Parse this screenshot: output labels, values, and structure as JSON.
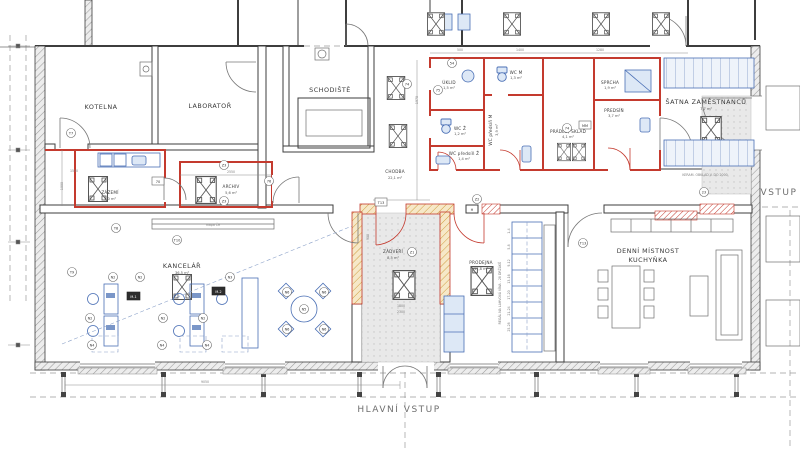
{
  "drawing": {
    "entrances": {
      "main": "HLAVNÍ VSTUP",
      "side": "VSTUP"
    },
    "rooms": [
      {
        "id": "kotelna",
        "name": "KOTELNA",
        "area": ""
      },
      {
        "id": "laborator",
        "name": "LABORATOŘ",
        "area": ""
      },
      {
        "id": "schodiste",
        "name": "SCHODIŠTĚ",
        "area": ""
      },
      {
        "id": "zazemi",
        "name": "ZÁZEMÍ",
        "area": "5,0 m²"
      },
      {
        "id": "archiv",
        "name": "ARCHIV",
        "area": "5,6 m²"
      },
      {
        "id": "chodba",
        "name": "CHODBA",
        "area": "22,1 m²"
      },
      {
        "id": "uklid",
        "name": "ÚKLID",
        "area": "1,5 m²"
      },
      {
        "id": "wc-z",
        "name": "WC Ž",
        "area": "1,2 m²"
      },
      {
        "id": "wc-predsin-z",
        "name": "WC předsíň Ž",
        "area": "1,4 m²"
      },
      {
        "id": "wc-m",
        "name": "WC M",
        "area": "1,3 m²"
      },
      {
        "id": "wc-predsin-m",
        "name": "WC předsíň M",
        "area": "3,9 m²"
      },
      {
        "id": "pradlo-sklad",
        "name": "PRÁDLO, SKLAD",
        "area": "4,1 m²"
      },
      {
        "id": "sprcha",
        "name": "SPRCHA",
        "area": "1,9 m²"
      },
      {
        "id": "predsin",
        "name": "PŘEDSÍŇ",
        "area": "3,7 m²"
      },
      {
        "id": "satna",
        "name": "ŠATNA ZAMĚSTNANCŮ",
        "area": "7,7 m²"
      },
      {
        "id": "kancelar",
        "name": "KANCELÁŘ",
        "area": "36,5 m²"
      },
      {
        "id": "zadveri",
        "name": "ZÁDVEŘÍ",
        "area": "8,5 m²"
      },
      {
        "id": "prodejna",
        "name": "PRODEJNA",
        "area": "11,8 m²"
      },
      {
        "id": "denni-mistnost",
        "name": "DENNÍ MÍSTNOST",
        "name2": "KUCHYŇKA",
        "area": ""
      }
    ],
    "notes": {
      "shelf": "REGÁL NA LAHVOVÁ VÍNA - 28 DRŽÁKŮ",
      "shelf_slots": [
        "1-4",
        "5-8",
        "9-12",
        "13-16",
        "17-20",
        "21-24",
        "25-28"
      ],
      "tiling": "KERAM. OBKLAD V. DO 2000",
      "map": "mapa ČR",
      "lintel": "H"
    },
    "dims": [
      "9050",
      "1800",
      "2300",
      "1550",
      "1000",
      "1970",
      "2550",
      "1400",
      "1280",
      "900",
      "500"
    ],
    "tags": [
      "T7",
      "T8",
      "T9",
      "T10",
      "T13",
      "Z1",
      "Z2",
      "Z3",
      "Z3",
      "74",
      "75",
      "76",
      "T13",
      "70",
      "N2",
      "N2",
      "N3",
      "N2",
      "N2",
      "N2",
      "N4",
      "N4",
      "N4",
      "N5",
      "N6",
      "N6",
      "N6",
      "N6",
      "M-1",
      "M-2",
      "MM",
      "54",
      "74",
      "23"
    ],
    "colors": {
      "wall": "#3d3d3d",
      "new_wall_red": "#c43a2e",
      "fixture_blue": "#4a6fb5",
      "fixture_blue_fill": "#dde8f6",
      "masonry_beige": "#f6e8c8",
      "masonry_beige_hatch": "#cf9d3f",
      "floor_gray": "#e9e9e9",
      "dim_gray": "#8a8a8a"
    }
  }
}
